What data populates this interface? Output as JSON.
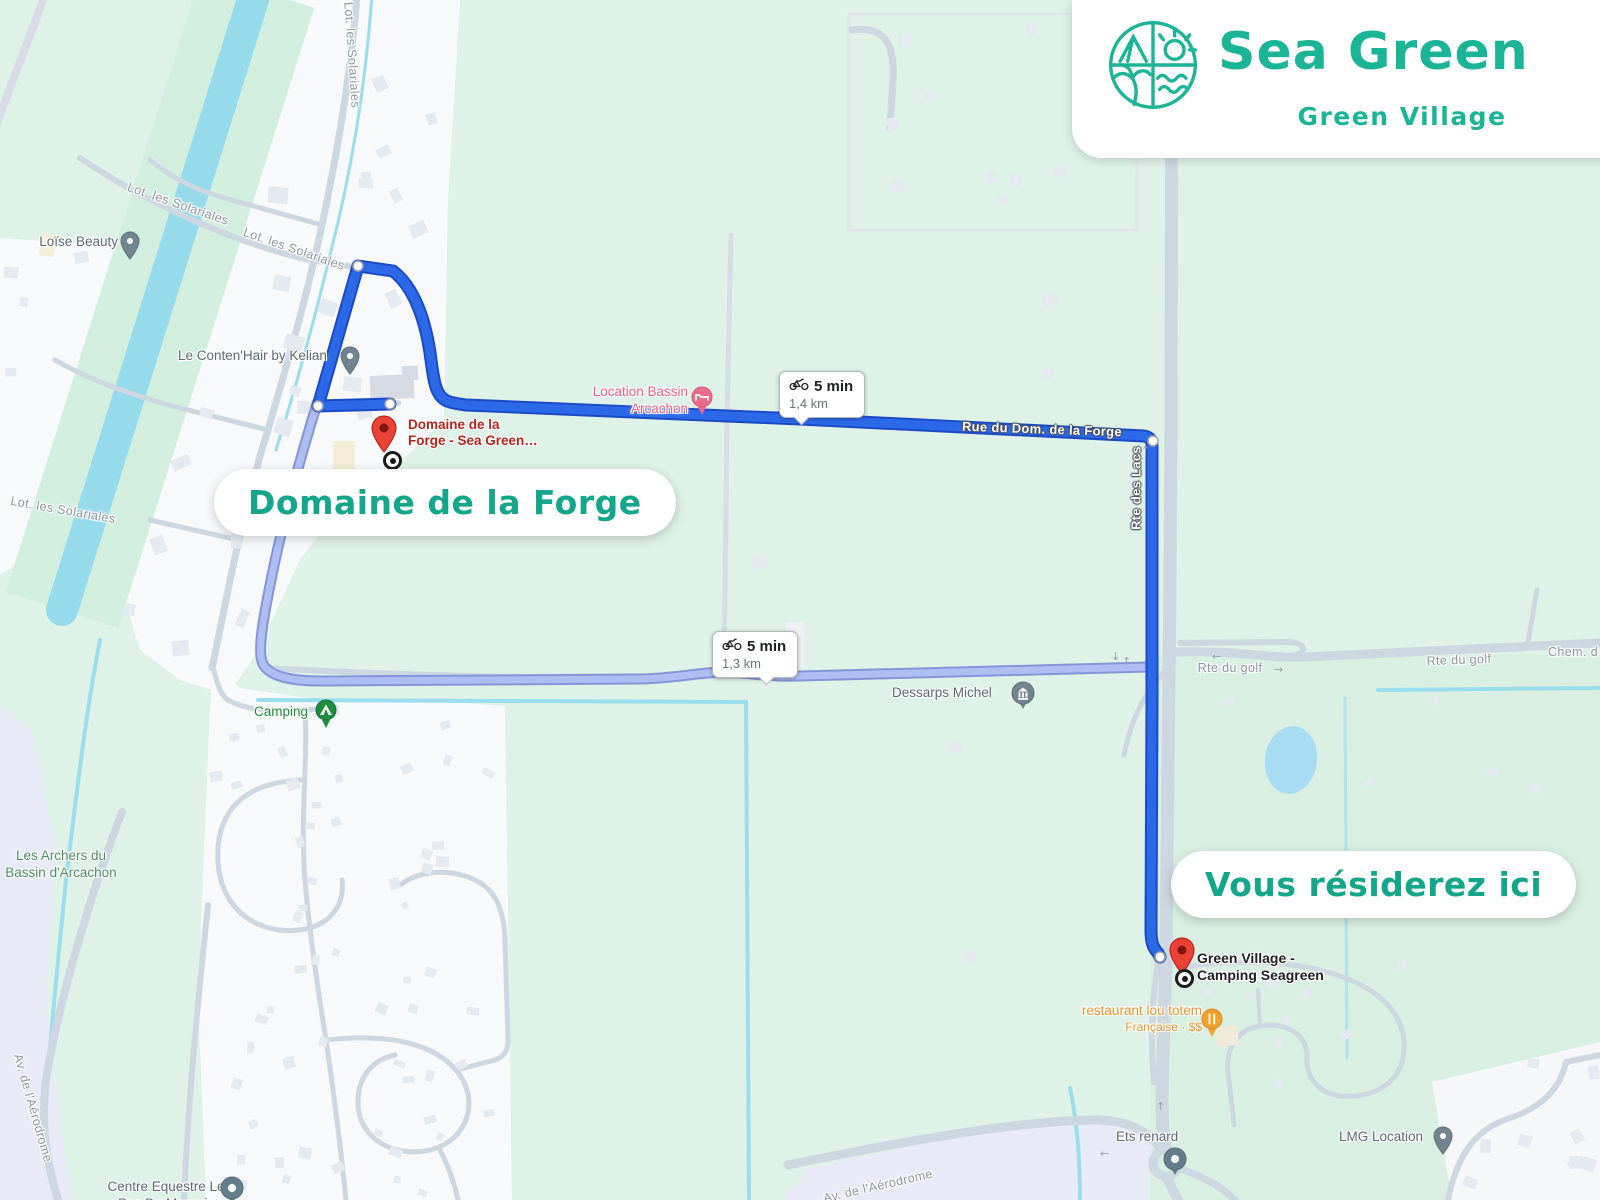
{
  "colors": {
    "brand_teal": "#1cb496",
    "route_blue": "#2c69e8",
    "alt_route_blue": "#aebef2",
    "marker_red": "#ea4335",
    "pin_gray": "#71848f",
    "poi_pink": "#ec5f85",
    "poi_orange": "#e8962f",
    "poi_green": "#1e8e3e"
  },
  "logo": {
    "brand": "Sea Green",
    "subtitle": "Green Village"
  },
  "callouts": {
    "origin": "Domaine de la Forge",
    "destination": "Vous résiderez ici"
  },
  "badges": [
    {
      "time": "5 min",
      "distance": "1,4 km"
    },
    {
      "time": "5 min",
      "distance": "1,3 km"
    }
  ],
  "markers": {
    "origin": {
      "line1": "Domaine de la",
      "line2": "Forge - Sea Green…"
    },
    "destination": {
      "line1": "Green Village -",
      "line2": "Camping Seagreen"
    },
    "loise": "Loïse Beauty",
    "kelian": "Le Conten'Hair by Kelian",
    "bassin": {
      "line1": "Location Bassin",
      "line2": "Arcachon"
    },
    "camping": "Camping",
    "dessarps": "Dessarps Michel",
    "restaurant": {
      "name": "restaurant lou totem",
      "meta": "Française · $$"
    },
    "ets_renard": "Ets renard",
    "lmg": "LMG Location",
    "equestre": {
      "line1": "Centre Equestre Le",
      "line2": "Pas Du Marquis"
    },
    "archers": {
      "line1": "Les Archers du",
      "line2": "Bassin d'Arcachon"
    }
  },
  "streets": {
    "solariales": "Lot. les Solariales",
    "rue_dom": "Rue du Dom. de la Forge",
    "lacs": "Rte des Lacs",
    "golf": "Rte du golf",
    "chem": "Chem. d",
    "aerodrome": "Av. de l'Aérodrome"
  }
}
